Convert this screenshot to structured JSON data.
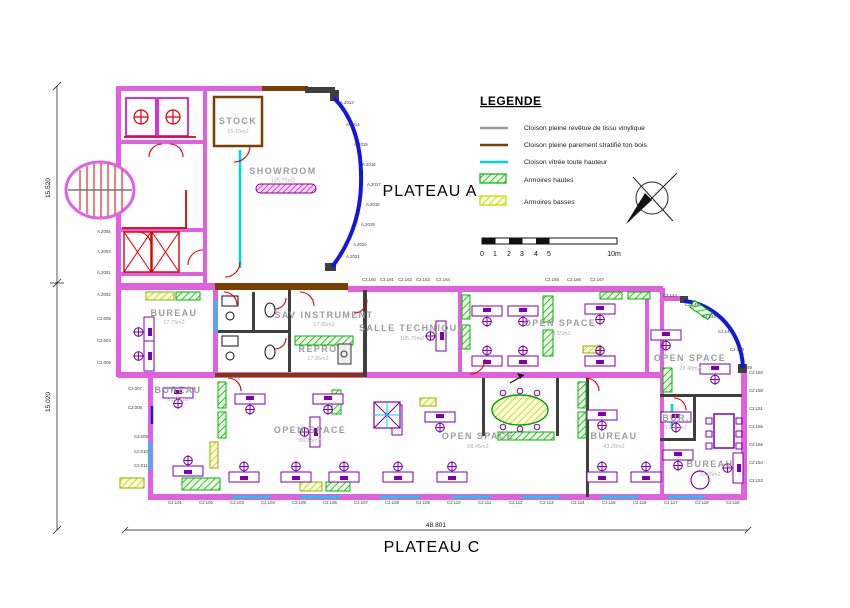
{
  "titles": {
    "plateau_a": "PLATEAU A",
    "plateau_c": "PLATEAU C"
  },
  "legend": {
    "title": "LEGENDE",
    "items": [
      {
        "label": "Cloison pleine revêtue de tissu vinylique",
        "swatch": "line",
        "color": "#9a9a9a"
      },
      {
        "label": "Cloison pleine parement stratifié ton bois",
        "swatch": "line",
        "color": "#7b3f00"
      },
      {
        "label": "Cloison vitrée toute hauteur",
        "swatch": "line",
        "color": "#00d2f0"
      },
      {
        "label": "Armoires hautes",
        "swatch": "box",
        "color": "#00b400"
      },
      {
        "label": "Armoires basses",
        "swatch": "box",
        "color": "#c8d400"
      }
    ]
  },
  "scale_bar": {
    "ticks": [
      "0",
      "1",
      "2",
      "3",
      "4",
      "5"
    ],
    "end": "10m"
  },
  "dimensions": {
    "left_upper": "15.520",
    "left_lower": "15.020",
    "bottom": "48.801"
  },
  "rooms": [
    {
      "name": "STOCK",
      "area": "15.15m2"
    },
    {
      "name": "SHOWROOM",
      "area": "105.75m2"
    },
    {
      "name": "BUREAU",
      "area": "17.75m2"
    },
    {
      "name": "SAV INSTRUMENT",
      "area": "17.85m2"
    },
    {
      "name": "REPRO",
      "area": "17.85m2"
    },
    {
      "name": "SALLE TECHNIQUE",
      "area": "105.75m2"
    },
    {
      "name": "OPEN SPACE",
      "area": "74.55m2"
    },
    {
      "name": "OPEN SPACE",
      "area": "28.40m2"
    },
    {
      "name": "BUREAU",
      "area": "31.85m2"
    },
    {
      "name": "OPEN SPACE",
      "area": "86.85m2"
    },
    {
      "name": "OPEN SPACE",
      "area": "68.45m2"
    },
    {
      "name": "BUREAU",
      "area": "43.20m2"
    },
    {
      "name": "BUR.",
      "area": "13.40m2"
    },
    {
      "name": "BUREAU",
      "area": "30.25m2"
    }
  ],
  "codes": {
    "facade_a": [
      "A.2013",
      "A.2014",
      "A.2015",
      "A.2016",
      "A.2017",
      "A.2018",
      "A.2019",
      "A.2020",
      "A.2021"
    ],
    "facade_c": [
      "C2.144",
      "C2.145",
      "C2.146",
      "C2.147",
      "C2.148",
      "C2.149"
    ],
    "top_band": [
      "C2.160",
      "C2.161",
      "C2.162",
      "C2.163",
      "C2.164",
      "C2.165",
      "C2.166",
      "C2.167"
    ],
    "bottom_row": [
      "C2.101",
      "C2.102",
      "C2.103",
      "C2.104",
      "C2.105",
      "C2.106",
      "C2.107",
      "C2.108",
      "C2.109",
      "C2.110",
      "C2.111",
      "C2.112",
      "C2.113",
      "C2.114",
      "C2.115",
      "C2.116",
      "C2.117",
      "C2.118",
      "C2.119"
    ],
    "right_column": [
      "C2.150",
      "C2.158",
      "C2.151",
      "C2.156",
      "C2.155",
      "C2.154",
      "C2.153"
    ],
    "left_column": [
      "A.2004",
      "A.2003",
      "A.2001",
      "A.2002",
      "C2.005",
      "C2.004",
      "C2.006"
    ],
    "left_lower": [
      "C2.007",
      "C2.008",
      "C2.009",
      "C2.010",
      "C2.011"
    ]
  },
  "colors": {
    "wall_partition": "#e060df",
    "wall_wood": "#7b3f00",
    "glazing_facade": "#1515e0",
    "glass_partition": "#00d2f0",
    "cabinet_high": "#00b400",
    "cabinet_low": "#c8d400",
    "furniture": "#7d00a8",
    "door": "#e00000"
  }
}
